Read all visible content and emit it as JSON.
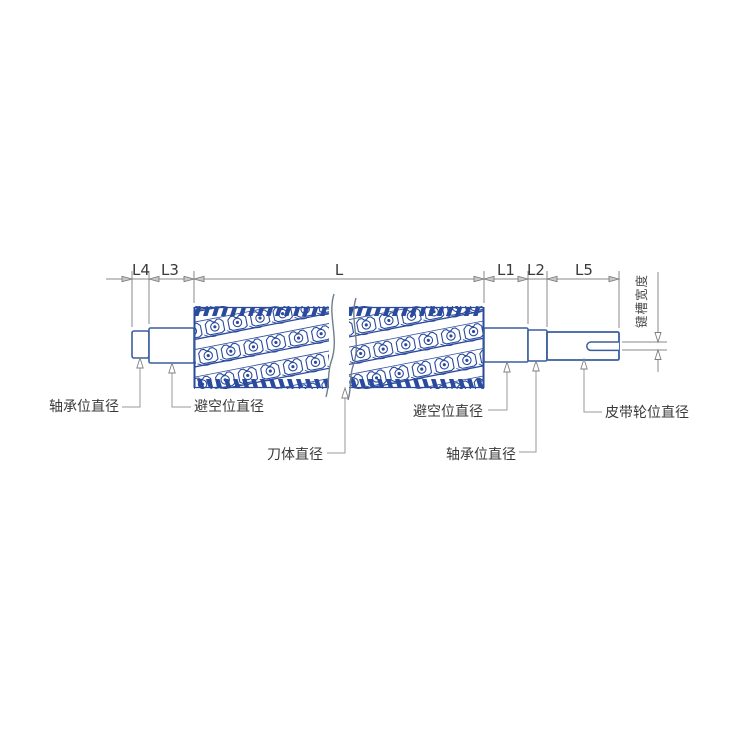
{
  "diagram": {
    "top_dimensions": [
      "L4",
      "L3",
      "L",
      "L1",
      "L2",
      "L5"
    ],
    "keyway_width_label": "键槽宽度",
    "callouts": {
      "bearing_left": "轴承位直径",
      "clearance_left": "避空位直径",
      "cutter_body": "刀体直径",
      "clearance_right": "避空位直径",
      "bearing_right": "轴承位直径",
      "pulley": "皮带轮位直径"
    },
    "colors": {
      "cutter_blue": "#2a4a9e",
      "shaft_outline_blue": "#3a5f9e",
      "dimension_gray": "#8a8a8a",
      "label_text": "#3a3a3a",
      "break_line_gray": "#6f7e8e"
    }
  }
}
